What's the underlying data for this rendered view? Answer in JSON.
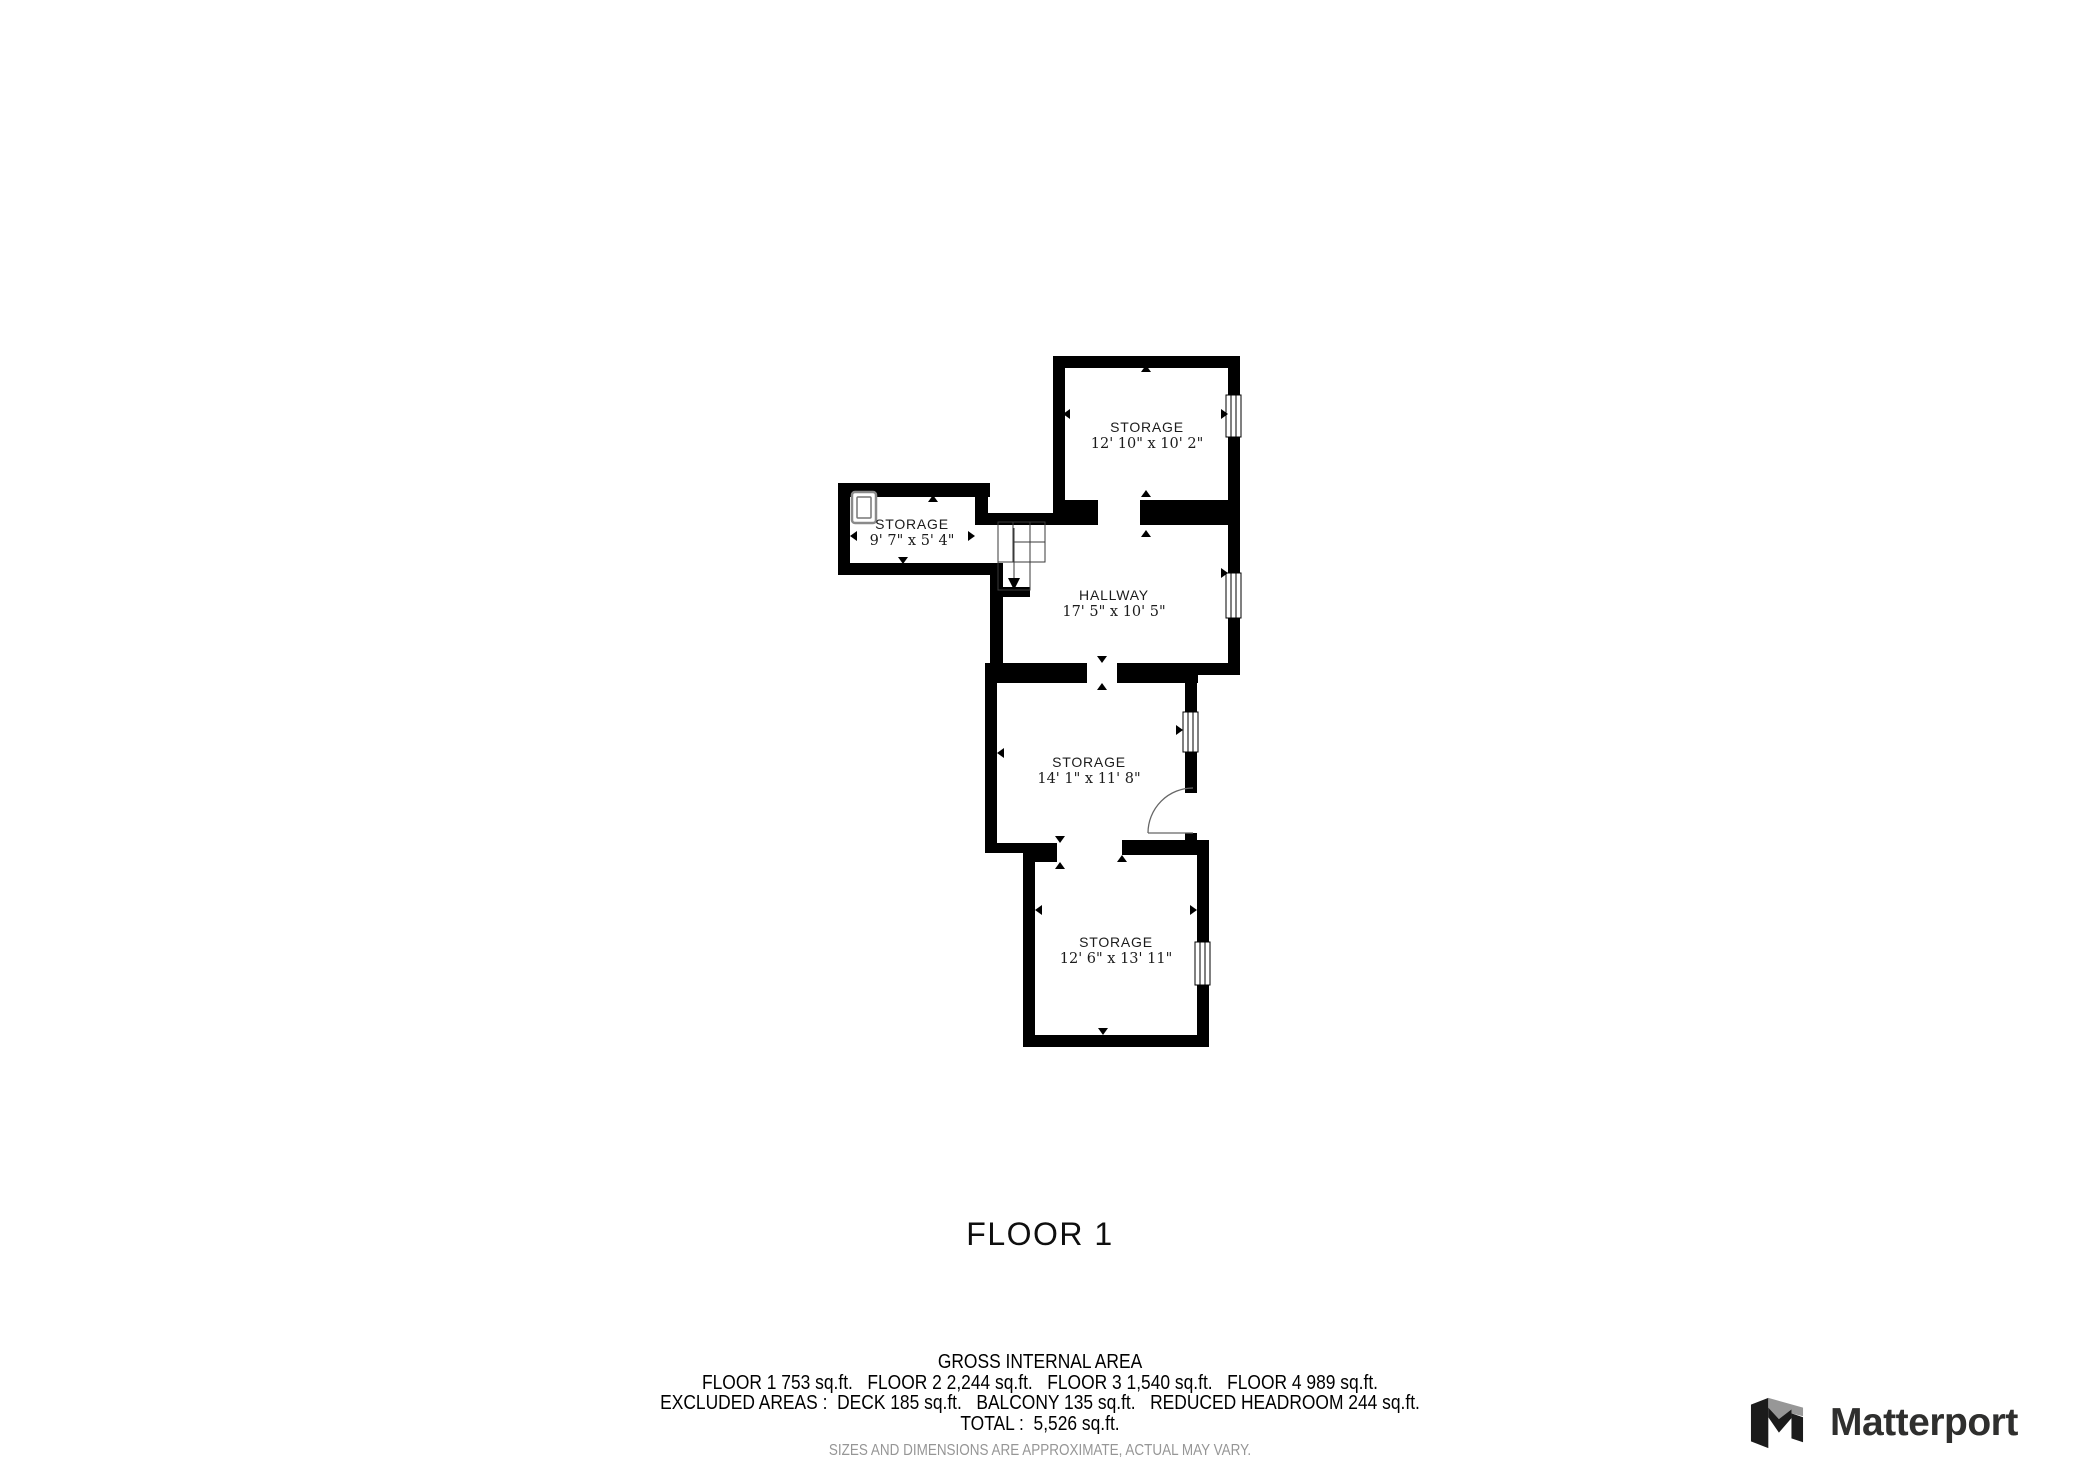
{
  "plan": {
    "floor_title": "FLOOR 1",
    "rooms": [
      {
        "name": "STORAGE",
        "dims": "12' 10\" x 10' 2\""
      },
      {
        "name": "STORAGE",
        "dims": "9' 7\" x 5' 4\""
      },
      {
        "name": "HALLWAY",
        "dims": "17' 5\" x 10' 5\""
      },
      {
        "name": "STORAGE",
        "dims": "14' 1\" x 11' 8\""
      },
      {
        "name": "STORAGE",
        "dims": "12' 6\" x 13' 11\""
      }
    ]
  },
  "area_summary": {
    "heading": "GROSS INTERNAL AREA",
    "line1": "FLOOR 1 753 sq.ft.   FLOOR 2 2,244 sq.ft.   FLOOR 3 1,540 sq.ft.   FLOOR 4 989 sq.ft.",
    "line2": "EXCLUDED AREAS :  DECK 185 sq.ft.   BALCONY 135 sq.ft.   REDUCED HEADROOM 244 sq.ft.",
    "line3": "TOTAL :  5,526 sq.ft.",
    "disclaimer": "SIZES AND DIMENSIONS ARE APPROXIMATE, ACTUAL MAY VARY."
  },
  "branding": {
    "logo_text": "Matterport"
  },
  "icons": {
    "stairs": "stairs-down-arrow",
    "door": "door-swing-arc",
    "window": "window-triple-pane",
    "fixture": "skylight",
    "logo": "matterport-folded-m"
  },
  "colors": {
    "wall": "#000000",
    "label_text": "#1c1c1c",
    "disclaimer_text": "#969696",
    "logo_dark": "#1b1b1b",
    "logo_gray": "#979797",
    "logo_text": "#2f2f2e"
  }
}
